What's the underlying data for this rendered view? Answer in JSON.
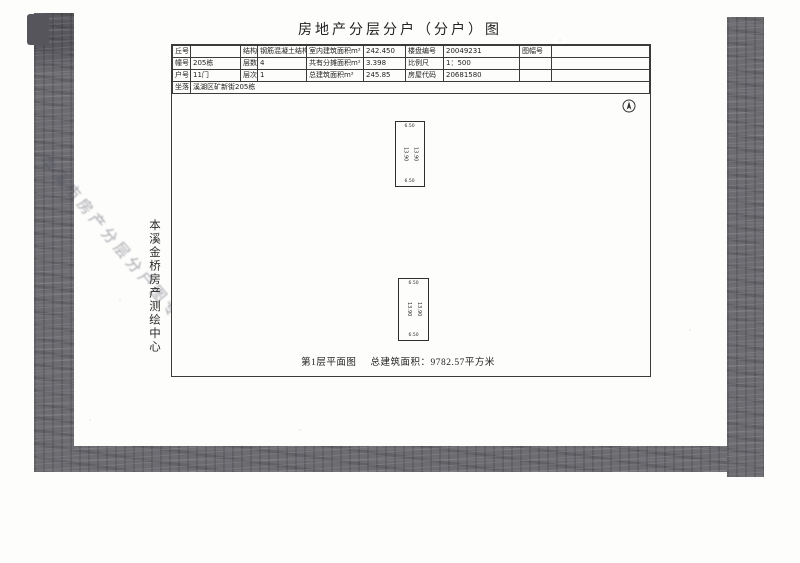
{
  "page": {
    "title": "房地产分层分户（分户）图"
  },
  "table": {
    "rows": [
      {
        "cells": [
          {
            "l": "丘号",
            "v": ""
          },
          {
            "l": "结构",
            "v": "钢筋混凝土结构"
          },
          {
            "l": "室内建筑面积m²",
            "v": "242.450"
          },
          {
            "l": "楼盘编号",
            "v": "20049231"
          },
          {
            "l": "图幅号",
            "v": ""
          }
        ]
      },
      {
        "cells": [
          {
            "l": "幢号",
            "v": "205栋"
          },
          {
            "l": "层数",
            "v": "4"
          },
          {
            "l": "共有分摊面积m²",
            "v": "3.398"
          },
          {
            "l": "比例尺",
            "v": "1：500"
          },
          {
            "l": "",
            "v": ""
          }
        ]
      },
      {
        "cells": [
          {
            "l": "户号",
            "v": "11门"
          },
          {
            "l": "层次",
            "v": "1"
          },
          {
            "l": "总建筑面积m²",
            "v": "245.85"
          },
          {
            "l": "房屋代码",
            "v": "20681580"
          },
          {
            "l": "",
            "v": ""
          }
        ]
      }
    ],
    "address": {
      "l": "坐落",
      "v": "溪湖区矿新街205栋"
    }
  },
  "plan": {
    "caption": {
      "floor": "第1层平面图",
      "area": "总建筑面积：9782.57平方米"
    },
    "units": [
      {
        "top": "6.50",
        "bottom": "6.50",
        "left": "13.90",
        "right": "13.90"
      },
      {
        "top": "6.50",
        "bottom": "6.50",
        "left": "13.90",
        "right": "13.90"
      }
    ]
  },
  "margins": {
    "vertical_org_text": "本溪金桥房产测绘中心",
    "stamp_text": "本溪市房产分层分户图专用章"
  },
  "colors": {
    "scan_band": "#6c6c71",
    "line": "#3b3b3b",
    "text": "#1e1e1e",
    "paper": "#fdfdfc"
  }
}
